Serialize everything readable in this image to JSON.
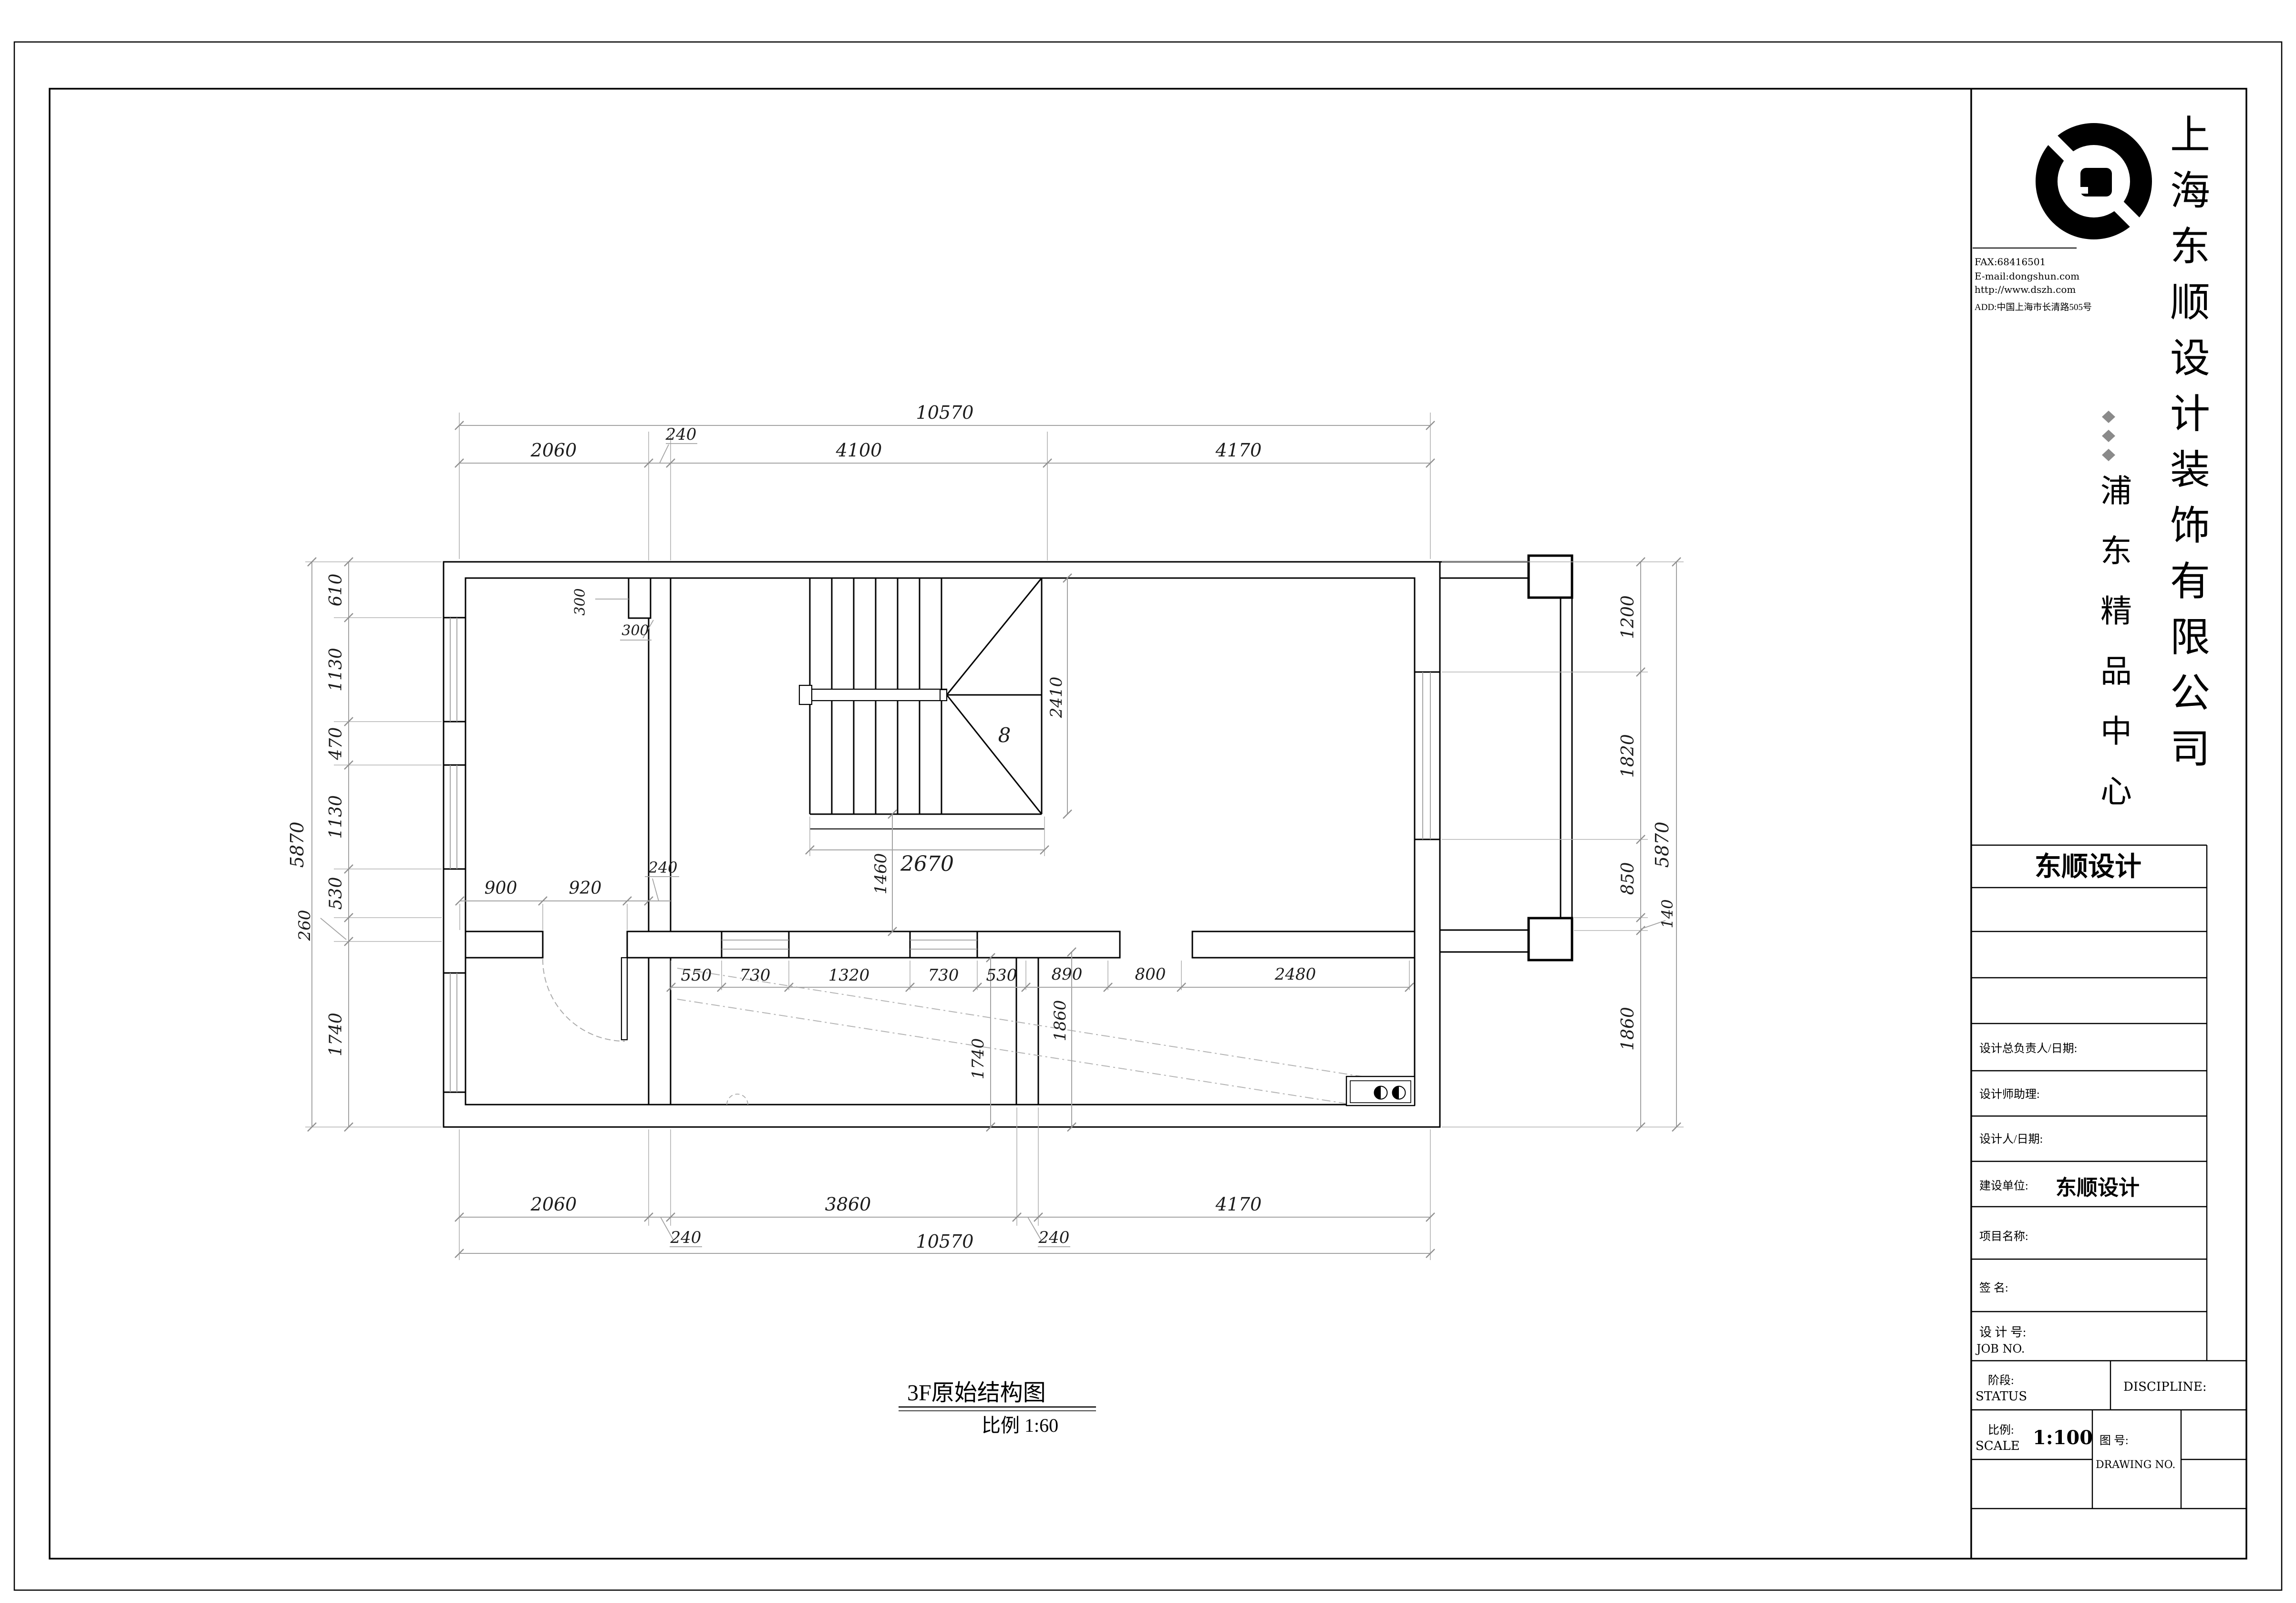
{
  "sheet": {
    "footer": {
      "drawing_title": "3F原始结构图",
      "scale_note": "比例 1:60"
    }
  },
  "title_block": {
    "logo": "dongshun-swirl-logo",
    "contact": {
      "fax": "FAX:68416501",
      "email": "E-mail:dongshun.com",
      "website": "http://www.dszh.com",
      "address": "ADD:中国上海市长清路505号"
    },
    "company_name_vertical": "上海东顺设计装饰有限公司",
    "project_name_vertical": "浦东精品中心",
    "brand_box": "东顺设计",
    "fields": {
      "chief_designer_label": "设计总负责人/日期:",
      "designer_assistant_label": "设计师助理:",
      "designer_date_label": "设计人/日期:",
      "client_label": "建设单位:",
      "client_value": "东顺设计",
      "project_label": "项目名称:",
      "signature_label": "签    名:",
      "job_no_cn": "设 计 号:",
      "job_no_en": "JOB NO.",
      "status_cn": "阶段:",
      "status_en": "STATUS",
      "discipline_en": "DISCIPLINE:",
      "scale_cn": "比例:",
      "scale_en": "SCALE",
      "scale_value": "1:100",
      "drawing_no_cn": "图    号:",
      "drawing_no_en": "DRAWING NO."
    }
  },
  "plan": {
    "stair_step_count": "8",
    "overall_width_mm": "10570",
    "overall_height_mm": "5870",
    "labels": [
      [
        "10570",
        1981,
        878,
        0,
        38
      ],
      [
        "2060",
        1161,
        957,
        0,
        38
      ],
      [
        "240",
        1428,
        922,
        0,
        34
      ],
      [
        "4100",
        1801,
        957,
        0,
        38
      ],
      [
        "4170",
        2597,
        957,
        0,
        38
      ],
      [
        "2060",
        1161,
        2538,
        0,
        38
      ],
      [
        "3860",
        1778,
        2538,
        0,
        38
      ],
      [
        "4170",
        2597,
        2538,
        0,
        38
      ],
      [
        "10570",
        1981,
        2616,
        0,
        38
      ],
      [
        "240",
        1438,
        2606,
        0,
        34
      ],
      [
        "240",
        2210,
        2606,
        0,
        34
      ],
      [
        "610",
        716,
        1237,
        1,
        36
      ],
      [
        "1130",
        716,
        1404,
        1,
        36
      ],
      [
        "470",
        716,
        1559,
        1,
        36
      ],
      [
        "1130",
        716,
        1713,
        1,
        36
      ],
      [
        "530",
        716,
        1873,
        1,
        36
      ],
      [
        "260",
        650,
        1940,
        1,
        34
      ],
      [
        "1740",
        716,
        2169,
        1,
        36
      ],
      [
        "5870",
        636,
        1771,
        1,
        38
      ],
      [
        "1200",
        3425,
        1294,
        1,
        36
      ],
      [
        "1820",
        3425,
        1585,
        1,
        36
      ],
      [
        "850",
        3425,
        1842,
        1,
        36
      ],
      [
        "140",
        3507,
        1916,
        1,
        32
      ],
      [
        "1860",
        3425,
        2157,
        1,
        36
      ],
      [
        "5870",
        3498,
        1771,
        1,
        38
      ],
      [
        "900",
        1050,
        1874,
        0,
        36
      ],
      [
        "920",
        1227,
        1874,
        0,
        36
      ],
      [
        "240",
        1390,
        1830,
        0,
        32
      ],
      [
        "550",
        1460,
        2056,
        0,
        34
      ],
      [
        "730",
        1583,
        2056,
        0,
        34
      ],
      [
        "1320",
        1780,
        2056,
        0,
        34
      ],
      [
        "730",
        1978,
        2056,
        0,
        34
      ],
      [
        "530",
        2100,
        2056,
        0,
        34
      ],
      [
        "890",
        2237,
        2054,
        0,
        34
      ],
      [
        "800",
        2412,
        2054,
        0,
        34
      ],
      [
        "2480",
        2716,
        2054,
        0,
        34
      ],
      [
        "2670",
        1944,
        1826,
        0,
        44
      ],
      [
        "1460",
        1858,
        1832,
        1,
        34
      ],
      [
        "2410",
        2226,
        1462,
        1,
        34
      ],
      [
        "1740",
        2062,
        2220,
        1,
        34
      ],
      [
        "1860",
        2234,
        2140,
        1,
        34
      ],
      [
        "300",
        1226,
        1262,
        1,
        30
      ],
      [
        "300",
        1332,
        1332,
        0,
        30
      ],
      [
        "8",
        2106,
        1556,
        0,
        42
      ]
    ]
  }
}
